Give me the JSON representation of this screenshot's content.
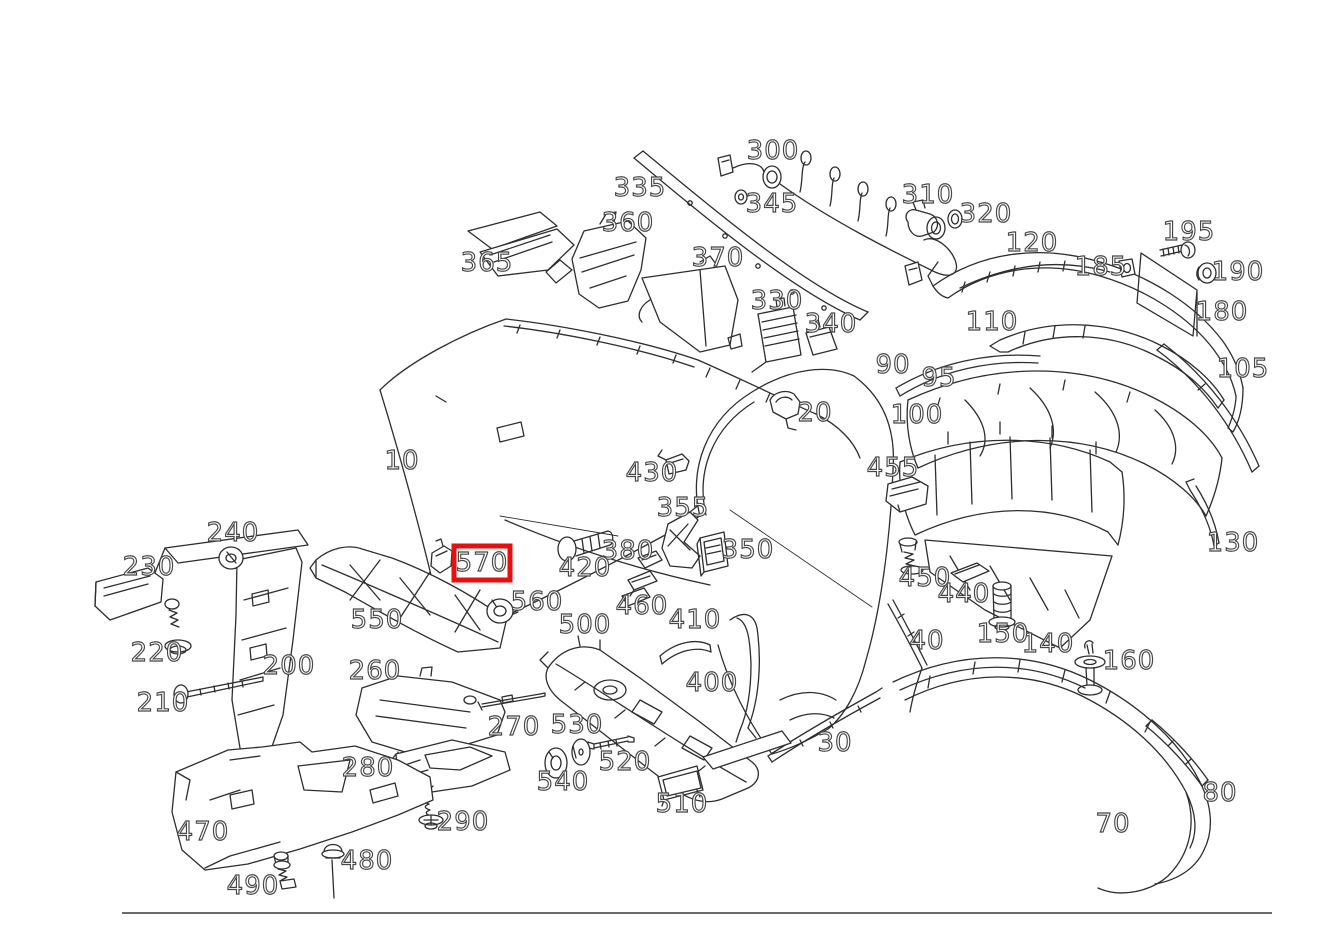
{
  "diagram": {
    "type": "exploded-parts-diagram",
    "description": "Rear bumper exploded view parts diagram with numbered callouts",
    "background_color": "#ffffff",
    "line_color": "#2e2e2e",
    "label_style": {
      "fill": "#ffffff",
      "outline": "#474747",
      "font_size": 26
    },
    "highlight": {
      "part": "570",
      "color": "#e8100f",
      "x": 454,
      "y": 546,
      "width": 56,
      "height": 34,
      "border": 5
    },
    "footer_divider": {
      "x1": 122,
      "y1": 913,
      "x2": 1272,
      "y2": 913,
      "color": "#3a3a3a"
    },
    "labels": [
      {
        "text": "10",
        "x": 402,
        "y": 461
      },
      {
        "text": "20",
        "x": 815,
        "y": 413
      },
      {
        "text": "30",
        "x": 835,
        "y": 743
      },
      {
        "text": "40",
        "x": 927,
        "y": 641
      },
      {
        "text": "70",
        "x": 1113,
        "y": 824
      },
      {
        "text": "80",
        "x": 1220,
        "y": 793
      },
      {
        "text": "90",
        "x": 893,
        "y": 365
      },
      {
        "text": "95",
        "x": 939,
        "y": 378
      },
      {
        "text": "100",
        "x": 917,
        "y": 415
      },
      {
        "text": "105",
        "x": 1243,
        "y": 369
      },
      {
        "text": "110",
        "x": 992,
        "y": 322
      },
      {
        "text": "120",
        "x": 1032,
        "y": 243
      },
      {
        "text": "130",
        "x": 1233,
        "y": 543
      },
      {
        "text": "140",
        "x": 1048,
        "y": 644
      },
      {
        "text": "150",
        "x": 1003,
        "y": 634
      },
      {
        "text": "160",
        "x": 1129,
        "y": 661
      },
      {
        "text": "180",
        "x": 1222,
        "y": 312
      },
      {
        "text": "185",
        "x": 1101,
        "y": 267
      },
      {
        "text": "190",
        "x": 1238,
        "y": 272
      },
      {
        "text": "195",
        "x": 1189,
        "y": 232
      },
      {
        "text": "200",
        "x": 289,
        "y": 666
      },
      {
        "text": "210",
        "x": 163,
        "y": 703
      },
      {
        "text": "220",
        "x": 157,
        "y": 653
      },
      {
        "text": "230",
        "x": 149,
        "y": 567
      },
      {
        "text": "240",
        "x": 233,
        "y": 533
      },
      {
        "text": "260",
        "x": 375,
        "y": 671
      },
      {
        "text": "270",
        "x": 514,
        "y": 727
      },
      {
        "text": "280",
        "x": 368,
        "y": 768
      },
      {
        "text": "290",
        "x": 463,
        "y": 822
      },
      {
        "text": "300",
        "x": 773,
        "y": 151
      },
      {
        "text": "310",
        "x": 928,
        "y": 195
      },
      {
        "text": "320",
        "x": 986,
        "y": 214
      },
      {
        "text": "330",
        "x": 777,
        "y": 301
      },
      {
        "text": "335",
        "x": 640,
        "y": 188
      },
      {
        "text": "340",
        "x": 831,
        "y": 324
      },
      {
        "text": "345",
        "x": 772,
        "y": 204
      },
      {
        "text": "350",
        "x": 748,
        "y": 550
      },
      {
        "text": "355",
        "x": 683,
        "y": 508
      },
      {
        "text": "360",
        "x": 628,
        "y": 223
      },
      {
        "text": "365",
        "x": 487,
        "y": 263
      },
      {
        "text": "370",
        "x": 718,
        "y": 258
      },
      {
        "text": "380",
        "x": 628,
        "y": 551
      },
      {
        "text": "400",
        "x": 712,
        "y": 683
      },
      {
        "text": "410",
        "x": 695,
        "y": 620
      },
      {
        "text": "420",
        "x": 585,
        "y": 568
      },
      {
        "text": "430",
        "x": 652,
        "y": 473
      },
      {
        "text": "440",
        "x": 964,
        "y": 594
      },
      {
        "text": "450",
        "x": 925,
        "y": 578
      },
      {
        "text": "455",
        "x": 893,
        "y": 468
      },
      {
        "text": "460",
        "x": 642,
        "y": 606
      },
      {
        "text": "470",
        "x": 203,
        "y": 832
      },
      {
        "text": "480",
        "x": 367,
        "y": 861
      },
      {
        "text": "490",
        "x": 253,
        "y": 886
      },
      {
        "text": "500",
        "x": 585,
        "y": 625
      },
      {
        "text": "510",
        "x": 682,
        "y": 804
      },
      {
        "text": "520",
        "x": 625,
        "y": 762
      },
      {
        "text": "530",
        "x": 577,
        "y": 725
      },
      {
        "text": "540",
        "x": 563,
        "y": 782
      },
      {
        "text": "550",
        "x": 377,
        "y": 620
      },
      {
        "text": "560",
        "x": 537,
        "y": 602
      },
      {
        "text": "570",
        "x": 482,
        "y": 563
      }
    ]
  }
}
